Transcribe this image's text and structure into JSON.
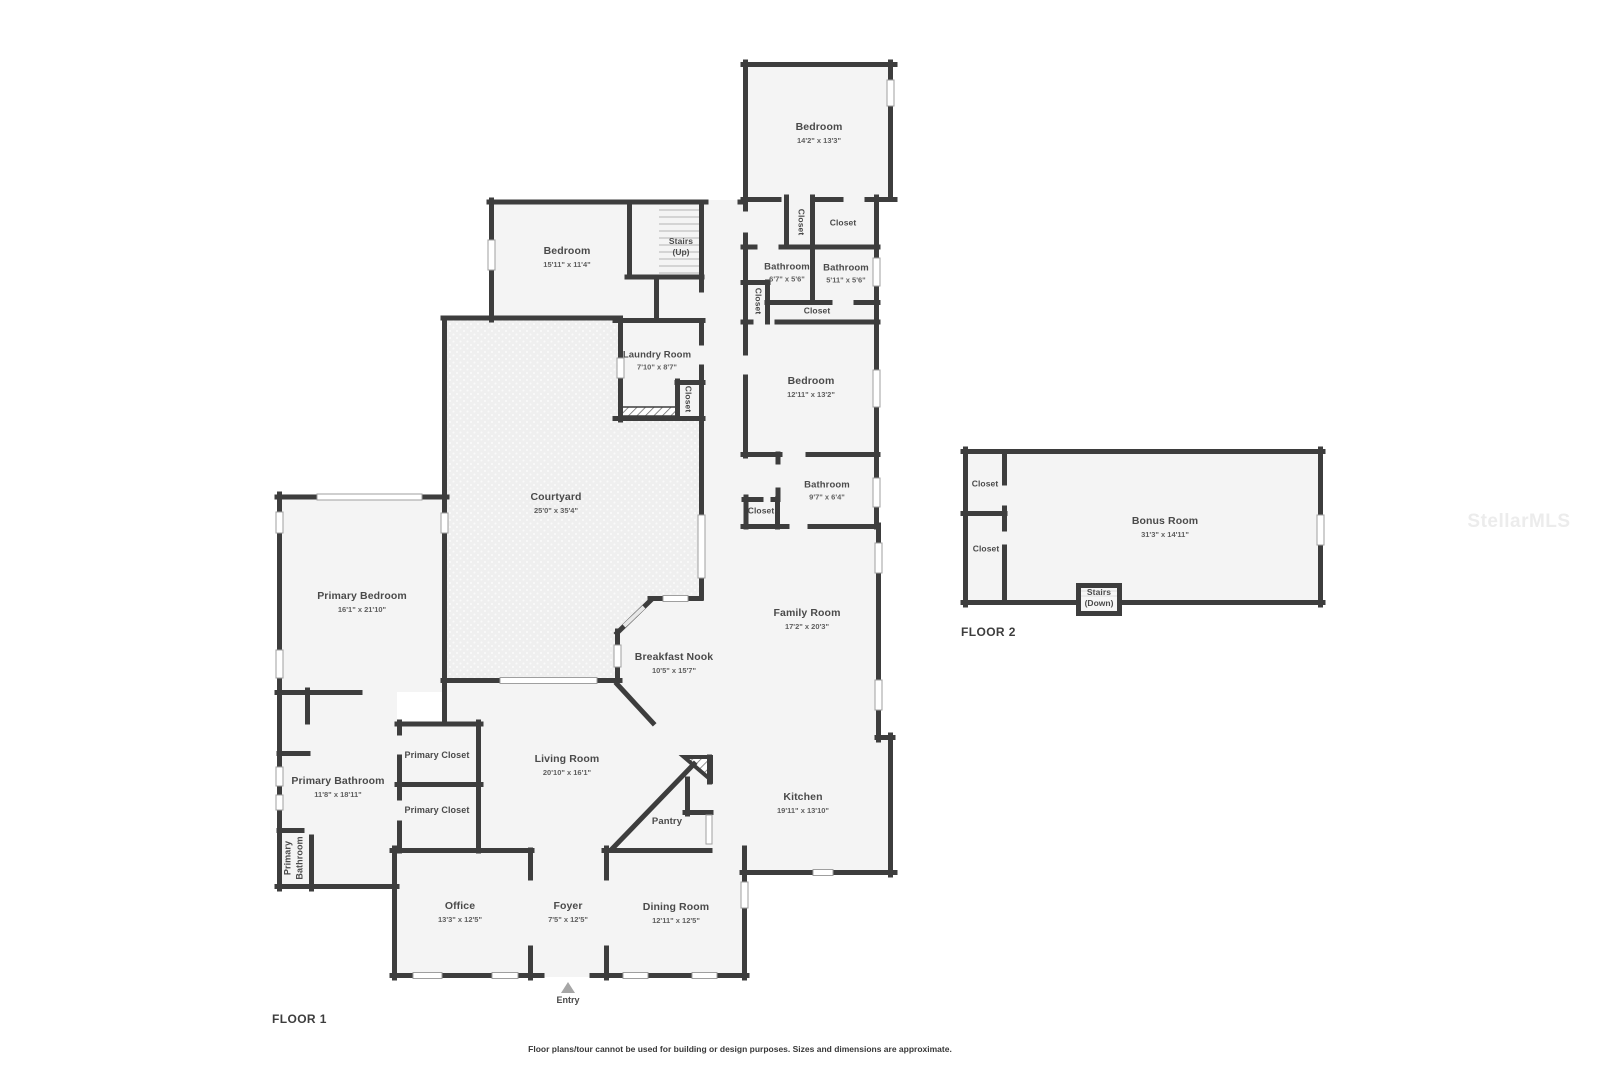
{
  "floor1": {
    "title": "FLOOR 1",
    "entry_label": "Entry",
    "rooms": {
      "bedroom_ne": {
        "name": "Bedroom",
        "dims": "14'2\" x 13'3\""
      },
      "closet_ne_v": {
        "name": "Closet"
      },
      "closet_ne": {
        "name": "Closet"
      },
      "bathroom_a": {
        "name": "Bathroom",
        "dims": "6'7\" x 5'6\""
      },
      "bathroom_b": {
        "name": "Bathroom",
        "dims": "5'11\" x 5'6\""
      },
      "closet_bath_v": {
        "name": "Closet"
      },
      "closet_strip": {
        "name": "Closet"
      },
      "bedroom_e": {
        "name": "Bedroom",
        "dims": "12'11\" x 13'2\""
      },
      "bedroom_nw": {
        "name": "Bedroom",
        "dims": "15'11\" x 11'4\""
      },
      "stairs_up": {
        "name": "Stairs",
        "dims": "(Up)"
      },
      "laundry": {
        "name": "Laundry Room",
        "dims": "7'10\" x 8'7\""
      },
      "closet_laundry": {
        "name": "Closet"
      },
      "courtyard": {
        "name": "Courtyard",
        "dims": "25'0\" x 35'4\""
      },
      "bathroom_c": {
        "name": "Bathroom",
        "dims": "9'7\" x 6'4\""
      },
      "closet_bath3": {
        "name": "Closet"
      },
      "family_room": {
        "name": "Family Room",
        "dims": "17'2\" x 20'3\""
      },
      "breakfast_nook": {
        "name": "Breakfast Nook",
        "dims": "10'5\" x 15'7\""
      },
      "primary_bedroom": {
        "name": "Primary Bedroom",
        "dims": "16'1\" x 21'10\""
      },
      "primary_closet_a": {
        "name": "Primary Closet"
      },
      "primary_closet_b": {
        "name": "Primary Closet"
      },
      "living_room": {
        "name": "Living Room",
        "dims": "20'10\" x 16'1\""
      },
      "primary_bathroom": {
        "name": "Primary Bathroom",
        "dims": "11'8\" x 18'11\""
      },
      "primary_wc": {
        "line1": "Primary",
        "line2": "Bathroom"
      },
      "pantry": {
        "name": "Pantry"
      },
      "kitchen": {
        "name": "Kitchen",
        "dims": "19'11\" x 13'10\""
      },
      "office": {
        "name": "Office",
        "dims": "13'3\" x 12'5\""
      },
      "foyer": {
        "name": "Foyer",
        "dims": "7'5\" x 12'5\""
      },
      "dining_room": {
        "name": "Dining Room",
        "dims": "12'11\" x 12'5\""
      }
    }
  },
  "floor2": {
    "title": "FLOOR 2",
    "rooms": {
      "bonus_room": {
        "name": "Bonus Room",
        "dims": "31'3\" x 14'11\""
      },
      "closet_upper": {
        "name": "Closet"
      },
      "closet_lower": {
        "name": "Closet"
      },
      "stairs_down": {
        "name": "Stairs",
        "dims": "(Down)"
      }
    }
  },
  "watermark": "StellarMLS",
  "disclaimer": "Floor plans/tour cannot be used for building or design purposes. Sizes and dimensions are approximate.",
  "colors": {
    "wall": "#3d3d3d",
    "room_fill": "#f4f4f4",
    "courtyard_fill": "#efefef",
    "text": "#4a4a4a"
  }
}
